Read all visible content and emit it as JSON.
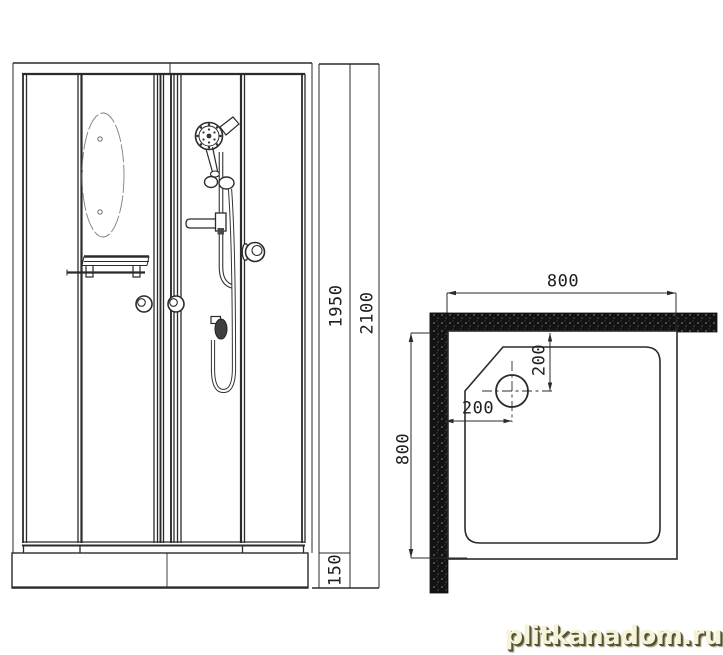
{
  "document": {
    "type": "technical-drawing",
    "subject": "shower cabin with sliding doors and square tray"
  },
  "front_view": {
    "name": "front-elevation",
    "dimensions": {
      "cabin_height": "1950",
      "total_height": "2100",
      "tray_height": "150"
    }
  },
  "plan_view": {
    "name": "top-plan",
    "dimensions": {
      "width": "800",
      "depth": "800",
      "drain_offset_from_back": "200",
      "drain_offset_from_side": "200"
    }
  },
  "watermark": {
    "text": "plitkanadom.ru",
    "color": "#f6f3da",
    "shadow_color": "#54542d"
  },
  "colors": {
    "line": "#2b2b2b",
    "wall_fill": "#131313",
    "background": "#ffffff"
  }
}
